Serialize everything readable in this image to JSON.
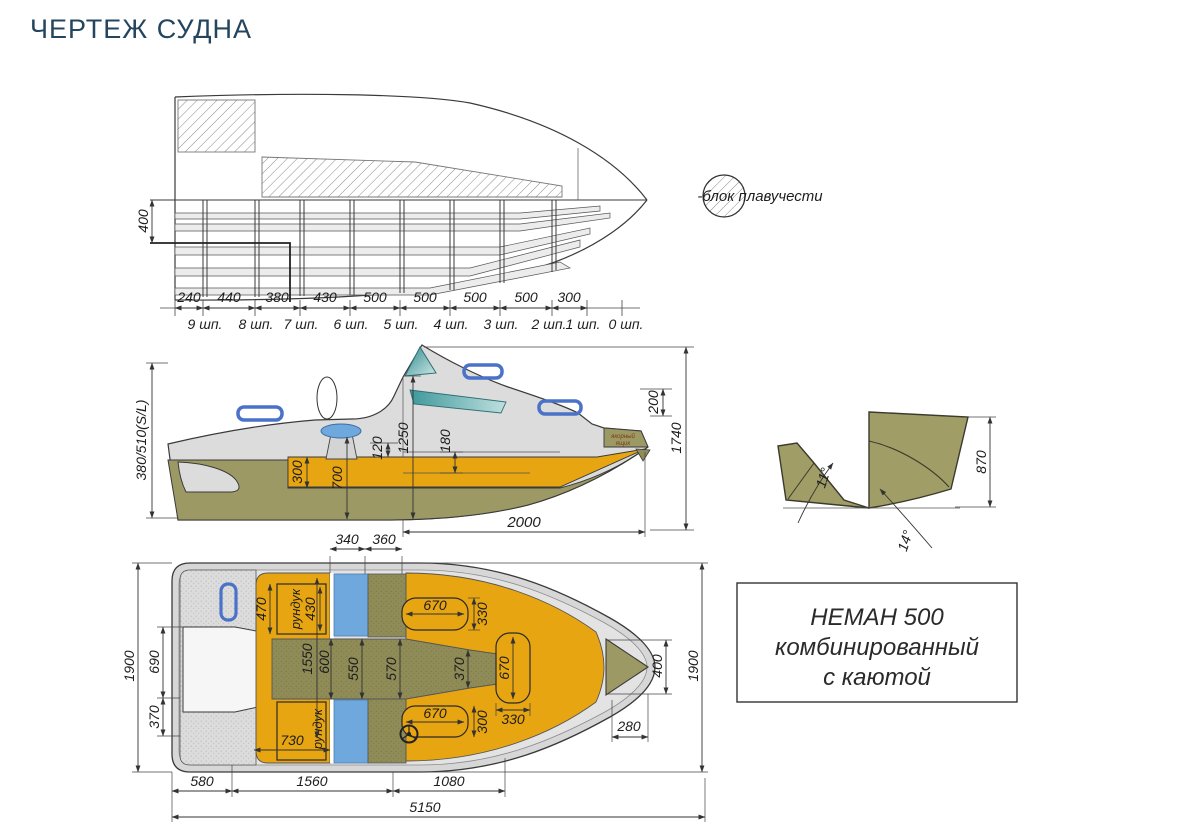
{
  "page": {
    "title": "ЧЕРТЕЖ СУДНА"
  },
  "legend": {
    "label": "-блок плавучести"
  },
  "structure_view": {
    "height_dim": "400",
    "spacings": [
      "240",
      "440",
      "380",
      "430",
      "500",
      "500",
      "500",
      "500",
      "300"
    ],
    "frame_labels": [
      "9 шп.",
      "8 шп.",
      "7 шп.",
      "6 шп.",
      "5 шп.",
      "4 шп.",
      "3 шп.",
      "2 шп.",
      "1 шп.",
      "0 шп."
    ]
  },
  "side_view": {
    "freeboard": "380/510(S/L)",
    "d300": "300",
    "d700": "700",
    "d120": "120",
    "d1250": "1250",
    "d180": "180",
    "d200": "200",
    "d1740": "1740",
    "d2000": "2000",
    "anchor_line1": "якорный",
    "anchor_line2": "ящик"
  },
  "transom_view": {
    "d870": "870",
    "angle_bottom": "11°",
    "angle_side": "14°"
  },
  "plan_view": {
    "d340": "340",
    "d360": "360",
    "d470": "470",
    "d430": "430",
    "locker": "рундук",
    "d730": "730",
    "d1550": "1550",
    "d600": "600",
    "d550": "550",
    "d570": "570",
    "d370_center": "370",
    "berth_len": "670",
    "d330": "330",
    "d300": "300",
    "d690": "690",
    "d370_left": "370",
    "d1900": "1900",
    "d400": "400",
    "d280": "280",
    "d580": "580",
    "d1560": "1560",
    "d1080": "1080",
    "d5150": "5150"
  },
  "title_block": {
    "line1": "НЕМАН 500",
    "line2": "комбинированный",
    "line3": "с каютой"
  },
  "palette": {
    "accent_title": "#24455e",
    "orange": "#e7a512",
    "olive": "#8f8c58",
    "olive_solid": "#a09d66",
    "hull_gray": "#dcdcdc",
    "seat_blue": "#6fa8dc",
    "glass_teal": "#2e8b8f",
    "line": "#333333"
  }
}
